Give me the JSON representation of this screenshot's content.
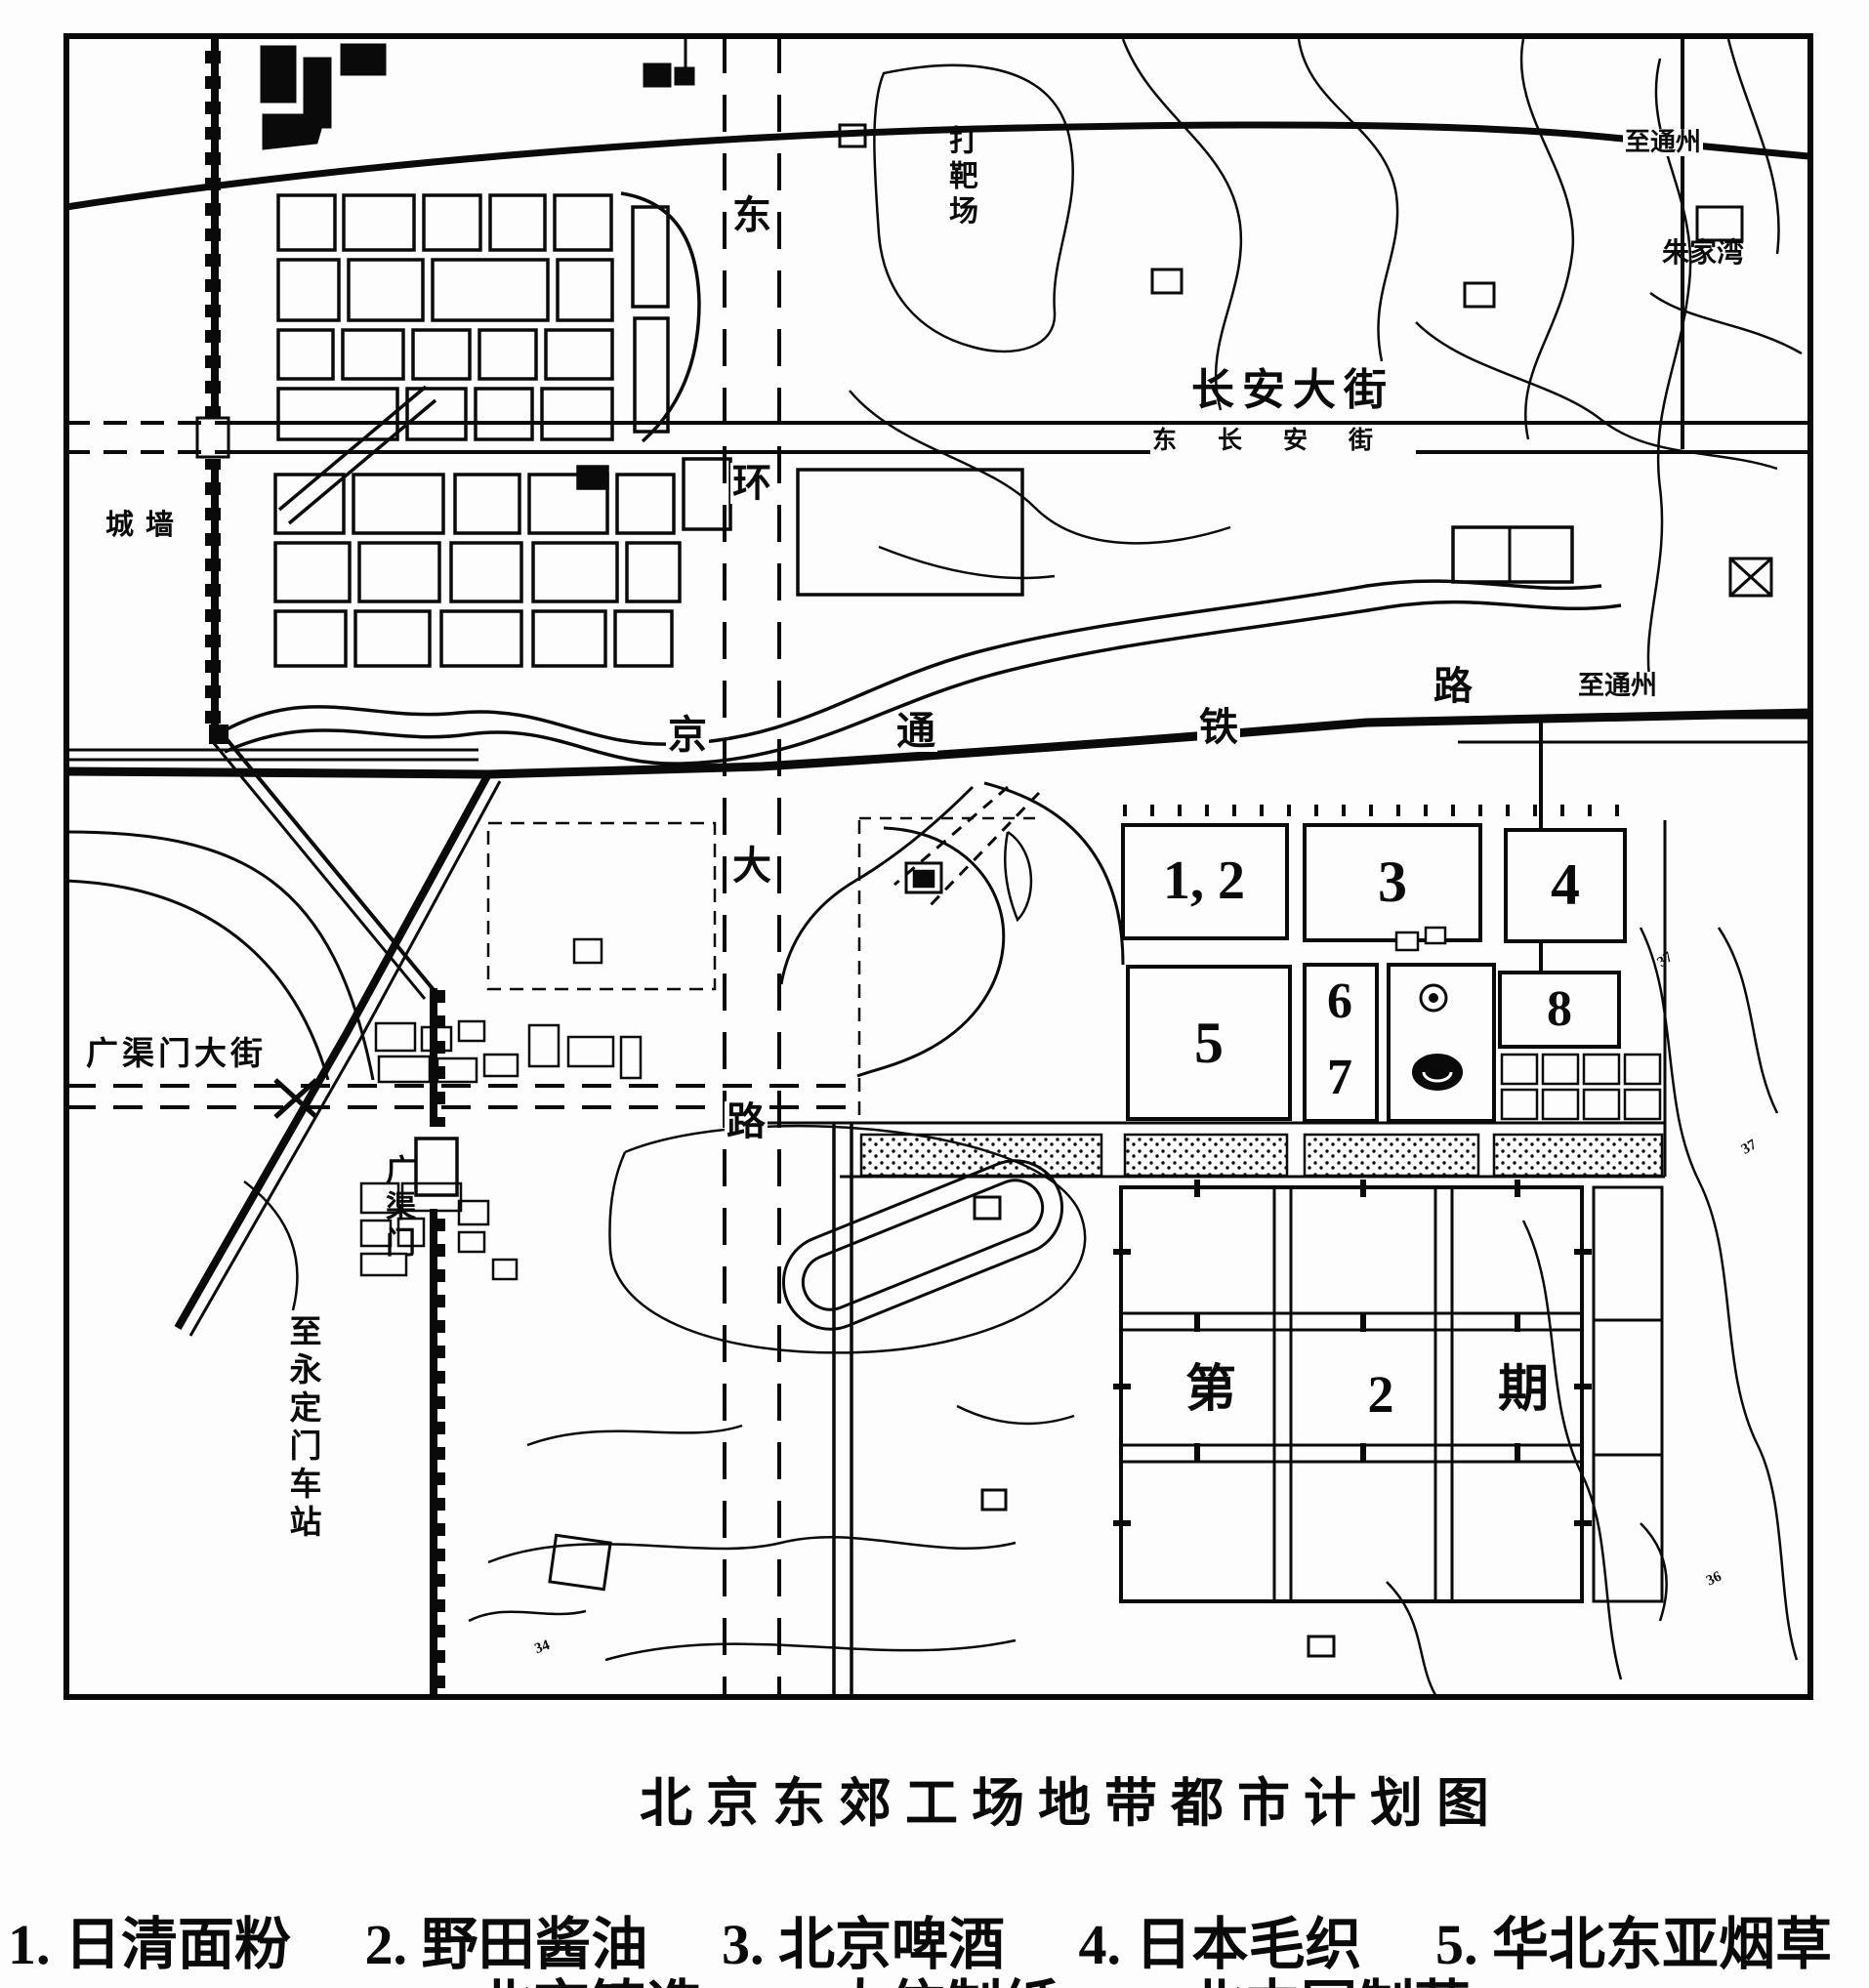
{
  "caption": {
    "title": "北京东郊工场地带都市计划图"
  },
  "legend": {
    "row1": [
      "1. 日清面粉",
      "2. 野田酱油",
      "3. 北京啤酒",
      "4. 日本毛织",
      "5. 华北东亚烟草"
    ],
    "row2": [
      "6. 北京铸造",
      "7. 大信制纸",
      "8. 北中国制药"
    ]
  },
  "map": {
    "ink_color": "#0a0a0a",
    "paper_color": "#fdfdfd",
    "labels": {
      "to_tongzhou_top": "至通州",
      "zhujiawan": "朱家湾",
      "changan_avenue": "长安大街",
      "east_changan_street": "东长安街",
      "city_wall": "城墙",
      "shooting_range": "打靶场",
      "ring_road_chars": [
        "东",
        "环",
        "大",
        "路"
      ],
      "railway_chars": [
        "京",
        "通",
        "铁",
        "路"
      ],
      "to_tongzhou_right": "至通州",
      "guangqumen_avenue": "广渠门大街",
      "guangqumen_gate": "广渠门",
      "to_yongdingmen_station": "至永定门车站",
      "contour_37a": "37",
      "contour_37b": "37",
      "contour_36": "36",
      "contour_34": "34"
    },
    "blocks": {
      "b12": "1, 2",
      "b3": "3",
      "b4": "4",
      "b5": "5",
      "b6": "6",
      "b7": "7",
      "b8": "8"
    },
    "phase2": {
      "char1": "第",
      "char2": "2",
      "char3": "期"
    }
  }
}
